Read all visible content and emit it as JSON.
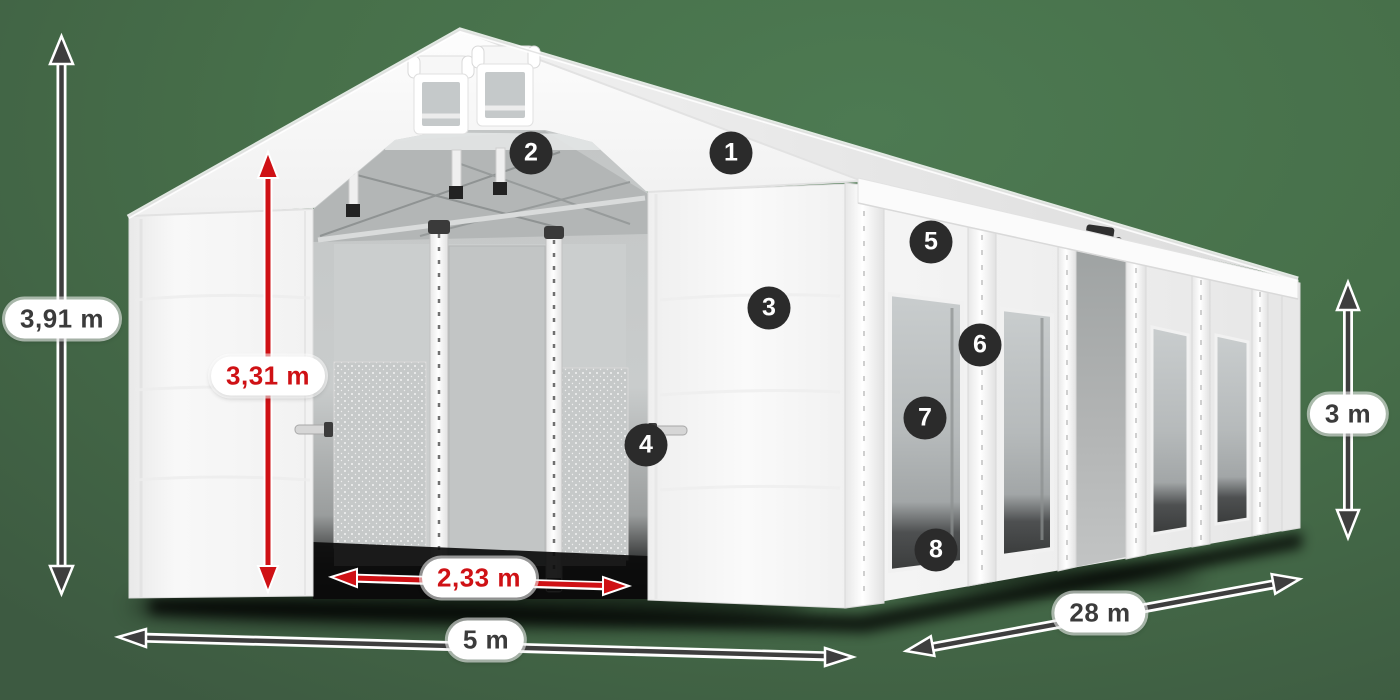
{
  "canvas": {
    "background_color": "#47704a"
  },
  "colors": {
    "arrow_dark": "#3e3e3e",
    "arrow_red": "#cf1115",
    "badge_background": "#2b2b2b",
    "badge_text": "#ffffff",
    "pill_background": "#ffffff",
    "pill_text_dark": "#3b3b3b",
    "tent_white": "#f6f6f6"
  },
  "dimensions": [
    {
      "id": "total-height",
      "label": "3,91 m",
      "style": "dark",
      "orientation": "vertical"
    },
    {
      "id": "inner-height",
      "label": "3,31 m",
      "style": "red",
      "orientation": "vertical"
    },
    {
      "id": "entrance-width",
      "label": "2,33 m",
      "style": "red",
      "orientation": "horizontal"
    },
    {
      "id": "width",
      "label": "5 m",
      "style": "dark",
      "orientation": "horizontal"
    },
    {
      "id": "length",
      "label": "28 m",
      "style": "dark",
      "orientation": "diagonal"
    },
    {
      "id": "side-height",
      "label": "3 m",
      "style": "dark",
      "orientation": "vertical"
    }
  ],
  "markers": [
    {
      "number": "1"
    },
    {
      "number": "2"
    },
    {
      "number": "3"
    },
    {
      "number": "4"
    },
    {
      "number": "5"
    },
    {
      "number": "6"
    },
    {
      "number": "7"
    },
    {
      "number": "8"
    }
  ]
}
